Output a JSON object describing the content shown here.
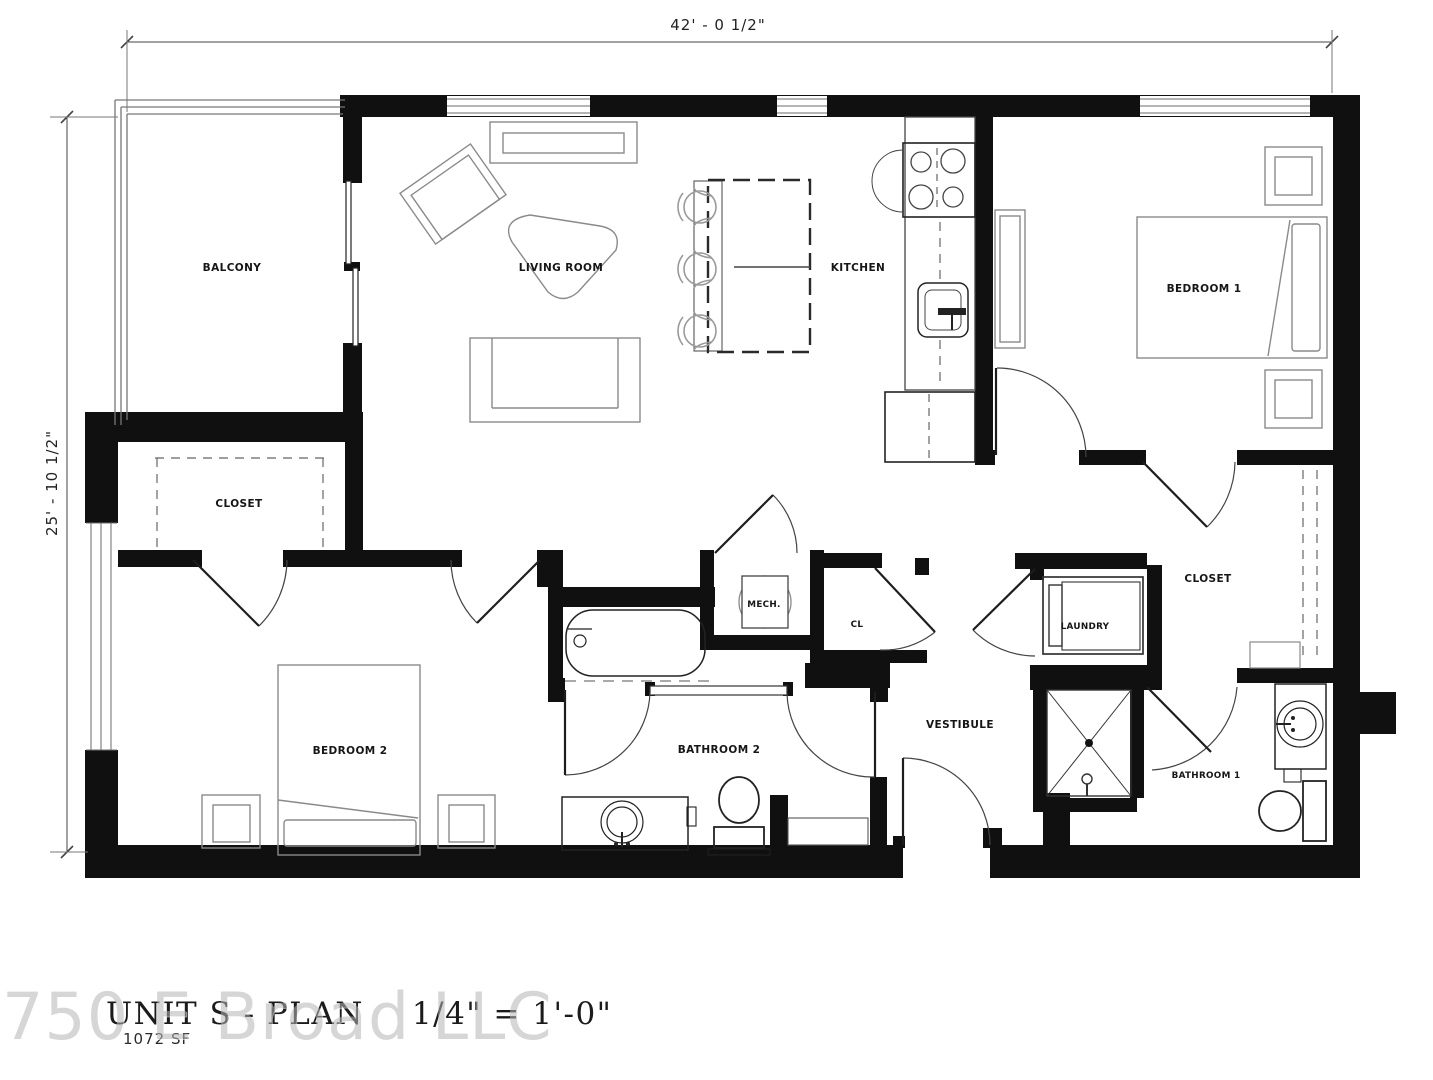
{
  "title_block": {
    "title": "UNIT S - PLAN",
    "scale": "1/4\" = 1'-0\"",
    "area": "1072 SF",
    "watermark": "750 E Broad LLC"
  },
  "dimensions": {
    "width": "42' - 0 1/2\"",
    "height": "25' - 10 1/2\""
  },
  "rooms": {
    "balcony": "BALCONY",
    "living_room": "LIVING ROOM",
    "kitchen": "KITCHEN",
    "bedroom1": "BEDROOM 1",
    "bedroom2": "BEDROOM 2",
    "closet_bedroom2": "CLOSET",
    "closet_walkin": "CLOSET",
    "mech": "MECH.",
    "cl": "CL",
    "bathroom1": "BATHROOM 1",
    "bathroom2": "BATHROOM 2",
    "laundry": "LAUNDRY",
    "vestibule": "VESTIBULE"
  },
  "colors": {
    "wall": "#101010",
    "furniture_line": "#555555",
    "door_line": "#333333",
    "watermark": "#b5b5b5"
  }
}
